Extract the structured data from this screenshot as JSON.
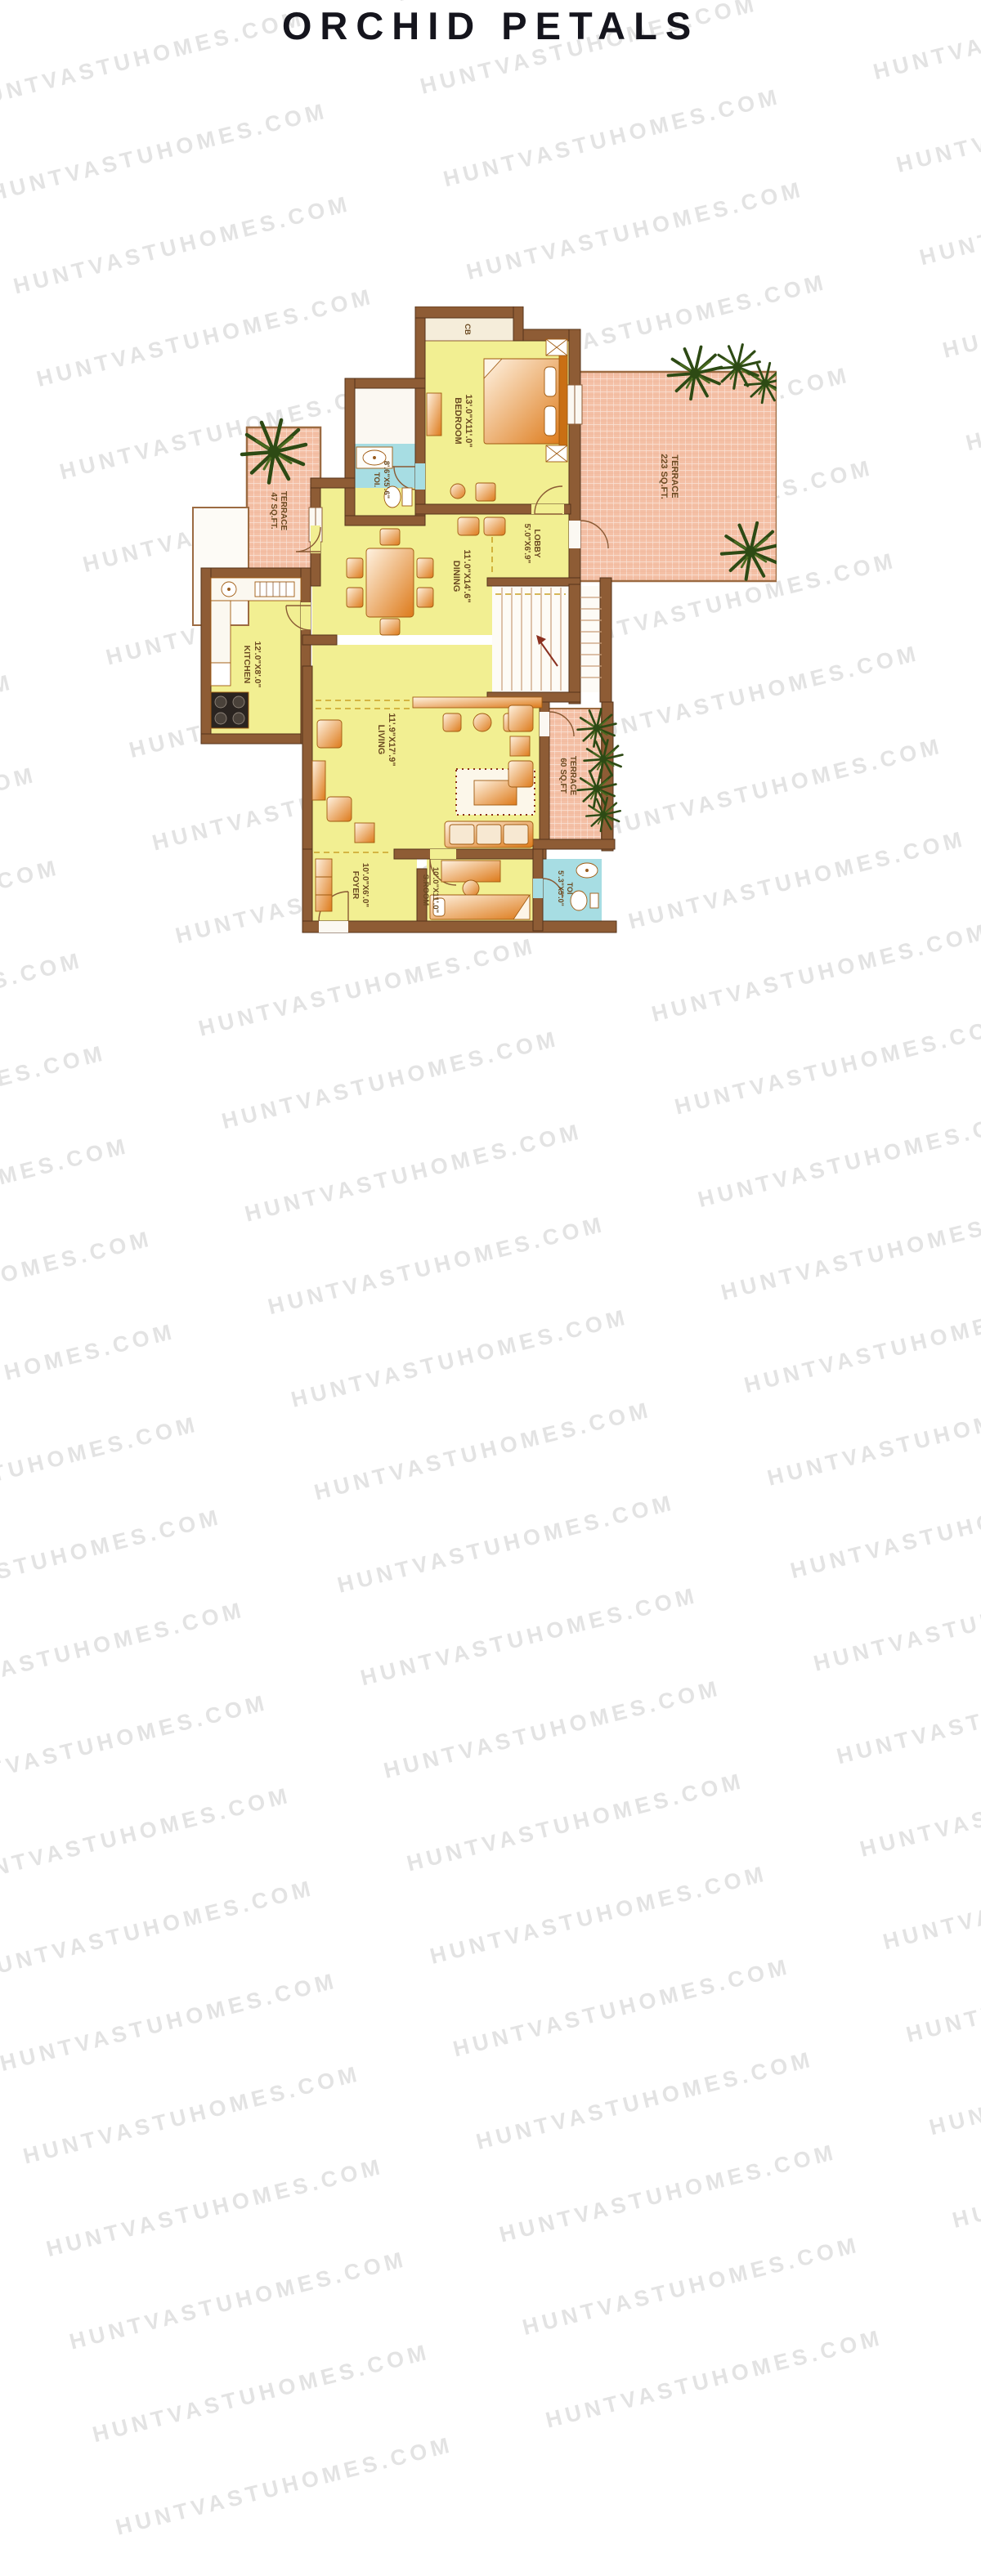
{
  "title": "ORCHID PETALS",
  "watermark": {
    "text": "HUNTVASTUHOMES.COM"
  },
  "plan": {
    "rooms": [
      {
        "id": "bedroom",
        "name": "BEDROOM",
        "dims": "13'.0\"X11'.0\""
      },
      {
        "id": "toilet-1",
        "name": "TOI.",
        "dims": "8'.6\"X5'.6\""
      },
      {
        "id": "terrace-223",
        "name": "TERRACE",
        "dims": "223 SQ.FT."
      },
      {
        "id": "lobby",
        "name": "LOBBY",
        "dims": "5'.0\"X6'.9\""
      },
      {
        "id": "dining",
        "name": "DINING",
        "dims": "11'.0\"X14'.6\""
      },
      {
        "id": "terrace-47",
        "name": "TERRACE",
        "dims": "47 SQ.FT."
      },
      {
        "id": "kitchen",
        "name": "KITCHEN",
        "dims": "12'.0\"X8'.0\""
      },
      {
        "id": "living",
        "name": "LIVING",
        "dims": "11'.9\"X17'.9\""
      },
      {
        "id": "terrace-60",
        "name": "TERRACE",
        "dims": "60 SQ.FT"
      },
      {
        "id": "foyer",
        "name": "FOYER",
        "dims": "10'.0\"X6'.0\""
      },
      {
        "id": "s-room",
        "name": "S.ROOM",
        "dims": "10'.0\"X11'.0\""
      },
      {
        "id": "toilet-2",
        "name": "TOI",
        "dims": "5'.3\"X5'.0\""
      },
      {
        "id": "cupboard",
        "name": "CB",
        "dims": ""
      }
    ],
    "colors": {
      "wall": "#8e5c35",
      "room_fill": "#f2ef92",
      "toilet_fill": "#a7dde3",
      "terrace_fill": "#f4c0a6",
      "furniture": "#dd7a1a",
      "plant": "#2d4a14",
      "label": "#6b4a22"
    }
  }
}
